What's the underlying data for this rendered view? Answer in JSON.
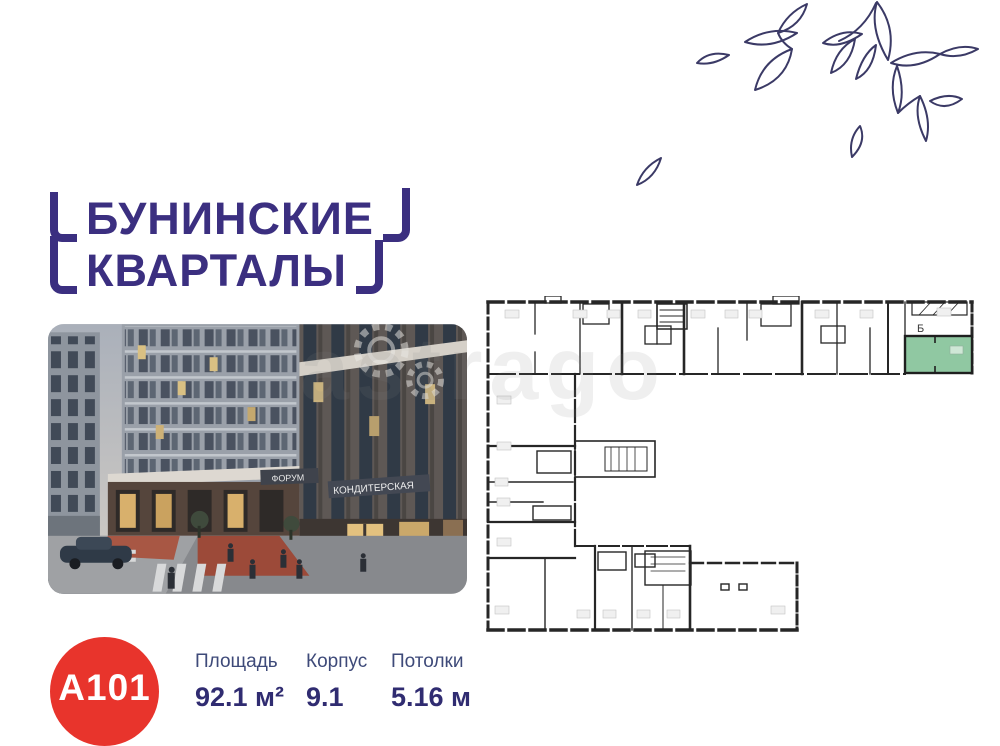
{
  "page": {
    "background": "#ffffff",
    "watermark": "astrago"
  },
  "logo": {
    "line1": "БУНИНСКИЕ",
    "line2": "КВАРТАЛЫ",
    "color": "#3b2f80"
  },
  "photo": {
    "description": "dusk street-view render of the residential complex with ground-floor retail",
    "signs": {
      "forum": "ФОРУМ",
      "confectionery": "КОНДИТЕРСКАЯ"
    }
  },
  "floorplan": {
    "marker": "Б",
    "wall_color": "#262626",
    "highlight_color": "#90c8a2"
  },
  "decor": {
    "leaves_color": "#3b3a66"
  },
  "unit": {
    "badge": "A101",
    "badge_bg": "#e8342c",
    "specs": [
      {
        "label": "Площадь",
        "value": "92.1 м²"
      },
      {
        "label": "Корпус",
        "value": "9.1"
      },
      {
        "label": "Потолки",
        "value": "5.16 м"
      }
    ]
  }
}
